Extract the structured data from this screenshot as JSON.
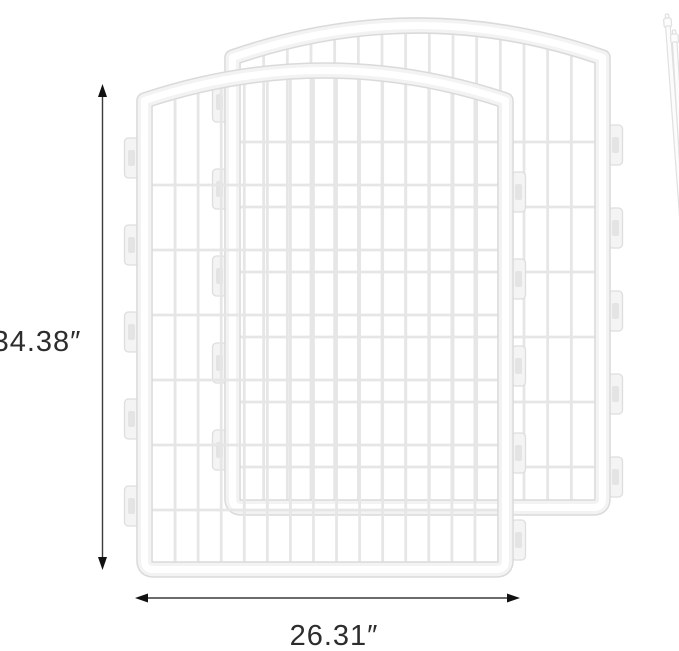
{
  "page": {
    "background": "#ffffff"
  },
  "dimensions": {
    "height": {
      "value": "34.38″",
      "orientation": "vertical"
    },
    "width": {
      "value": "26.31″",
      "orientation": "horizontal"
    }
  },
  "objects": {
    "panels": {
      "count": 2,
      "label": "wire pen panel"
    },
    "rods": {
      "count": 2,
      "label": "connector rod"
    }
  },
  "colors": {
    "background": "#ffffff",
    "frame_edge": "#dadada",
    "frame_body": "#f3f3f3",
    "frame_highlight": "#ffffff",
    "wire": "#e6e6e6",
    "tab_fill": "#f4f4f4",
    "tab_edge": "#dedede",
    "tab_slot": "#d8d8d8",
    "rod_fill": "#fcfcfc",
    "rod_edge": "#e0e0e0",
    "dimension_line": "#3a3a3a",
    "arrowhead": "#111111",
    "label_text": "#2d2d2d"
  }
}
